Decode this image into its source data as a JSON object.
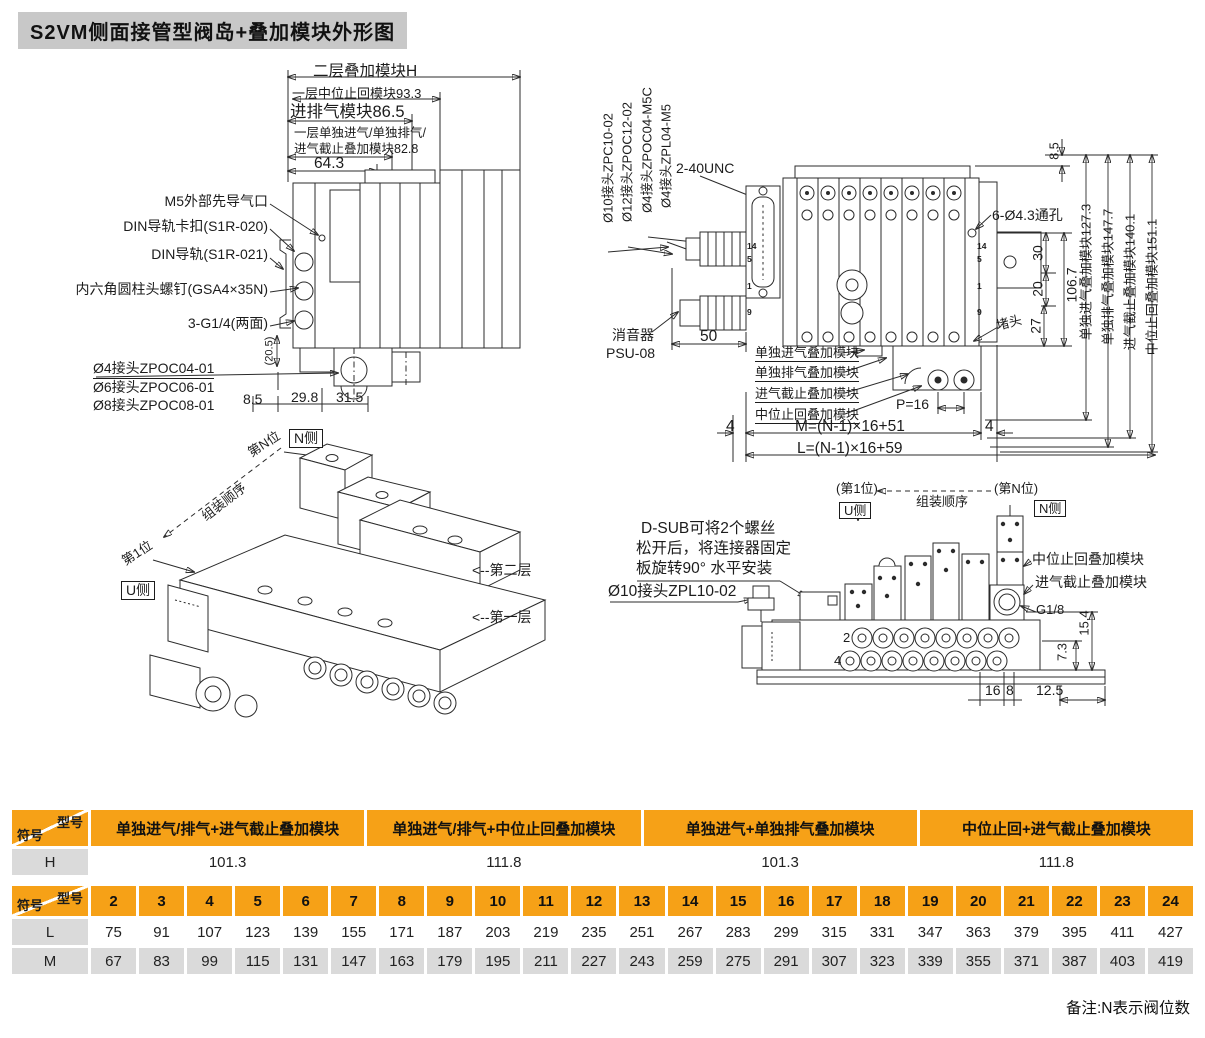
{
  "title": "S2VM侧面接管型阀岛+叠加模块外形图",
  "note": "备注:N表示阀位数",
  "colors": {
    "accent_orange": "#F6A117",
    "row_gray": "#DADADA",
    "title_gray": "#C8C8C8",
    "line": "#2B2B2B"
  },
  "front_view": {
    "dim_layer2": "二层叠加模块H",
    "dim_check": "一层中位止回模块93.3",
    "dim_supply": "进排气模块86.5",
    "dim_single_line1": "一层单独进气/单独排气/",
    "dim_single_line2": "进气截止叠加模块82.8",
    "dim_64_3": "64.3",
    "callout_m5": "M5外部先导气口",
    "callout_din_clip": "DIN导轨卡扣(S1R-020)",
    "callout_din_rail": "DIN导轨(S1R-021)",
    "callout_screw": "内六角圆柱头螺钉(GSA4×35N)",
    "callout_g14": "3-G1/4(两面)",
    "dim_20_5": "(20.5)",
    "fitting_zpoc04": "Ø4接头ZPOC04-01",
    "fitting_zpoc06": "Ø6接头ZPOC06-01",
    "fitting_zpoc08": "Ø8接头ZPOC08-01",
    "dim_8_5": "8.5",
    "dim_29_8": "29.8",
    "dim_31_5": "31.5"
  },
  "side_view": {
    "fitting_zpc10": "Ø10接头ZPC10-02",
    "fitting_zpoc12": "Ø12接头ZPOC12-02",
    "fitting_zpoc04m5c": "Ø4接头ZPOC04-M5C",
    "fitting_zpl04m5": "Ø4接头ZPL04-M5",
    "label_unc": "2-40UNC",
    "dim_8_5": "8.5",
    "label_holes": "6-Ø4.3通孔",
    "dim_mod_in": "单独进气叠加模块127.3",
    "dim_mod_out": "单独排气叠加模块147.7",
    "dim_mod_stop": "进气截止叠加模块140.1",
    "dim_mod_check": "中位止回叠加模块151.1",
    "dim_106_7": "106.7",
    "dim_30": "30",
    "dim_20": "20",
    "dim_27": "27",
    "label_plug": "堵头",
    "label_silencer_line1": "消音器",
    "label_silencer_line2": "PSU-08",
    "dim_50": "50",
    "mod_in": "单独进气叠加模块",
    "mod_out": "单独排气叠加模块",
    "mod_stop": "进气截止叠加模块",
    "mod_check": "中位止回叠加模块",
    "dim_p16": "P=16",
    "dim_4_left": "4",
    "dim_m_formula": "M=(N-1)×16+51",
    "dim_4_right": "4",
    "dim_l_formula": "L=(N-1)×16+59",
    "pins": [
      "14",
      "5",
      "1",
      "9"
    ]
  },
  "iso_view": {
    "n_side": "N侧",
    "pos_n": "第N位",
    "assembly_order": "组装顺序",
    "pos_1": "第1位",
    "u_side": "U侧",
    "layer2": "<--第二层",
    "layer1": "<--第一层"
  },
  "end_view": {
    "pos_1": "(第1位)",
    "u_side": "U侧",
    "assembly_order": "组装顺序",
    "pos_n": "(第N位)",
    "n_side": "N侧",
    "dsub_note_line1": "D-SUB可将2个螺丝",
    "dsub_note_line2": "松开后，将连接器固定",
    "dsub_note_line3": "板旋转90° 水平安装",
    "fitting_zpl10": "Ø10接头ZPL10-02",
    "mod_check": "中位止回叠加模块",
    "mod_stop": "进气截止叠加模块",
    "label_g18": "G1/8",
    "dim_15_4": "15.4",
    "dim_7_3": "7.3",
    "port_row2": "2",
    "port_row4": "4",
    "dim_16": "16",
    "dim_8": "8",
    "dim_12_5": "12.5"
  },
  "h_table": {
    "corner_top": "型号",
    "corner_bottom": "符号",
    "headers": [
      "单独进气/排气+进气截止叠加模块",
      "单独进气/排气+中位止回叠加模块",
      "单独进气+单独排气叠加模块",
      "中位止回+进气截止叠加模块"
    ],
    "row_label": "H",
    "values": [
      "101.3",
      "111.8",
      "101.3",
      "111.8"
    ]
  },
  "lm_table": {
    "corner_top": "型号",
    "corner_bottom": "符号",
    "headers": [
      "2",
      "3",
      "4",
      "5",
      "6",
      "7",
      "8",
      "9",
      "10",
      "11",
      "12",
      "13",
      "14",
      "15",
      "16",
      "17",
      "18",
      "19",
      "20",
      "21",
      "22",
      "23",
      "24"
    ],
    "rows": [
      {
        "label": "L",
        "values": [
          "75",
          "91",
          "107",
          "123",
          "139",
          "155",
          "171",
          "187",
          "203",
          "219",
          "235",
          "251",
          "267",
          "283",
          "299",
          "315",
          "331",
          "347",
          "363",
          "379",
          "395",
          "411",
          "427"
        ]
      },
      {
        "label": "M",
        "values": [
          "67",
          "83",
          "99",
          "115",
          "131",
          "147",
          "163",
          "179",
          "195",
          "211",
          "227",
          "243",
          "259",
          "275",
          "291",
          "307",
          "323",
          "339",
          "355",
          "371",
          "387",
          "403",
          "419"
        ]
      }
    ]
  }
}
